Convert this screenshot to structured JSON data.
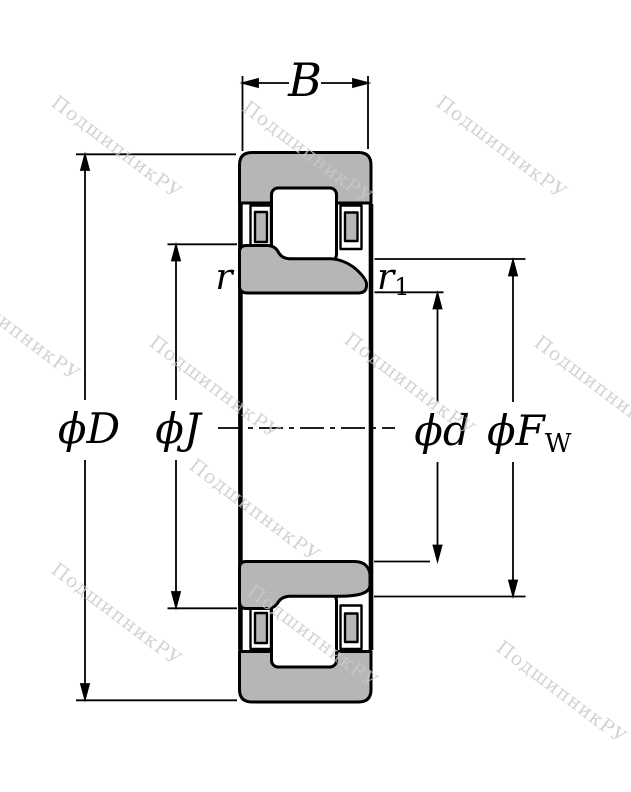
{
  "colors": {
    "ring_fill": "#b6b6b6",
    "cage_fill": "#b6b6b6",
    "roller_fill": "#ffffff",
    "outline": "#000000",
    "watermark": "#c9c9c9",
    "background": "#ffffff"
  },
  "labels": {
    "width": "B",
    "outer_diameter": "ϕD",
    "rib_diameter": "ϕJ",
    "bore_diameter": "ϕd",
    "raceway_diameter_base": "ϕF",
    "raceway_diameter_sub": "W",
    "chamfer_outer": "r",
    "chamfer_inner_base": "r",
    "chamfer_inner_sub": "1"
  },
  "watermark": {
    "text": "ПодшипникРУ"
  }
}
